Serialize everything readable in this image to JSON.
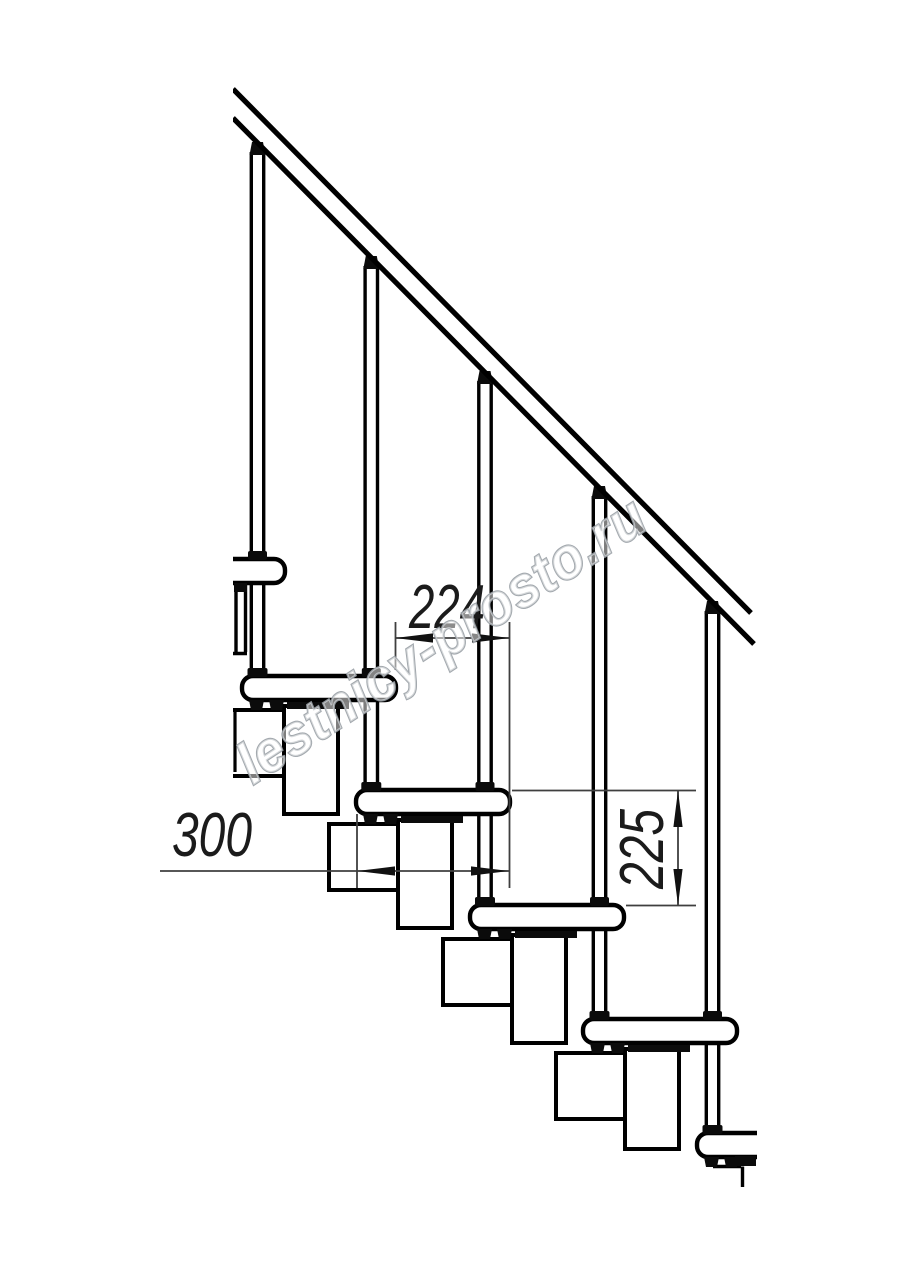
{
  "dimensions": {
    "going": "224",
    "depth": "300",
    "riser": "225"
  },
  "watermark": {
    "text": "lestnicy-prosto.ru"
  },
  "colors": {
    "ink": "#000000",
    "dim_line": "#3f3f3f",
    "watermark_stroke": "#9aa0a6",
    "background": "#ffffff"
  }
}
